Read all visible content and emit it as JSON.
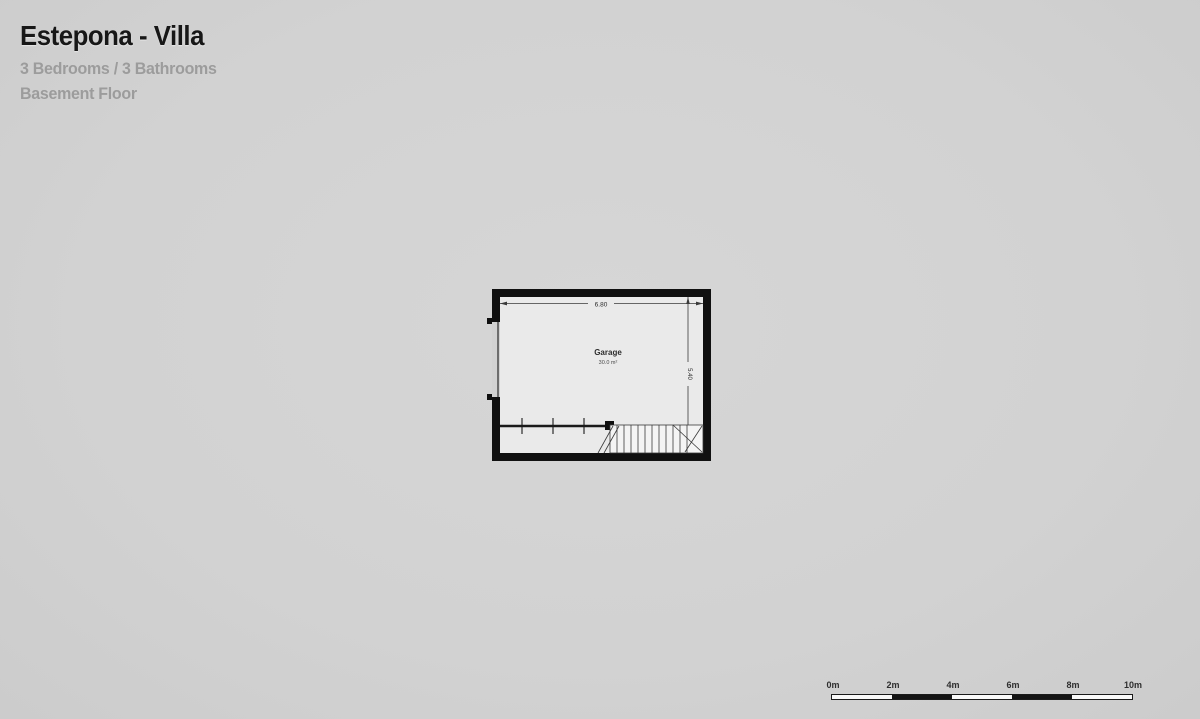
{
  "header": {
    "title": "Estepona - Villa",
    "details": "3 Bedrooms / 3 Bathrooms",
    "floor": "Basement Floor"
  },
  "floor_plan": {
    "room": {
      "name": "Garage",
      "area": "30.0 m²"
    },
    "dimensions": {
      "width": "6.80",
      "height": "5.40"
    }
  },
  "scale_bar": {
    "labels": [
      "0m",
      "2m",
      "4m",
      "6m",
      "8m",
      "10m"
    ]
  },
  "colors": {
    "background": "#d2d2d2",
    "plan_interior": "#eaeaea",
    "wall": "#111111",
    "title_text": "#171717",
    "subtitle_text": "#9c9c9c"
  }
}
